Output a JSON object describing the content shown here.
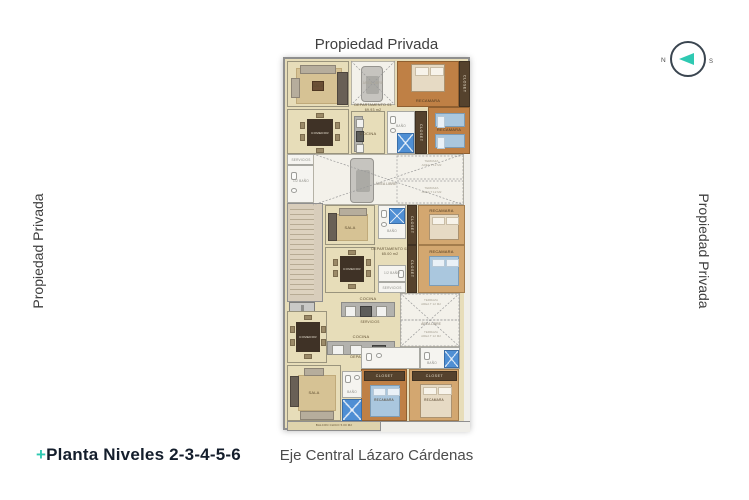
{
  "labels": {
    "propiedad_top": "Propiedad Privada",
    "propiedad_left": "Propiedad Privada",
    "propiedad_right": "Propiedad Privada",
    "street": "Eje Central Lázaro Cárdenas",
    "title_plus": "+",
    "title": "Planta Niveles 2-3-4-5-6"
  },
  "compass": {
    "north": "N",
    "south": "S"
  },
  "rooms": {
    "sala": "SALA",
    "comedor": "COMEDOR",
    "cocina": "COCINA",
    "bano": "BAÑO",
    "medio_bano": "1/2 BAÑO",
    "servicios": "SERVICIOS",
    "recamara": "RECAMARA",
    "closet": "CLOSET",
    "elevador": "ELEVADOR",
    "area_libre": "ÁREA LIBRE",
    "terraza": "TERRAZA",
    "terraza_area": "AREA T 12 M2",
    "balcon": "BALCON CHICO",
    "balcon_area": "5.00 M2"
  },
  "departamentos": {
    "d03": {
      "name": "DEPARTAMENTO 03",
      "area": "69.93 m2"
    },
    "d02": {
      "name": "DEPARTAMENTO 02",
      "area": "65.00 m2"
    },
    "d01": {
      "name": "DEPARTAMENTO 01",
      "area": "78.80 m2"
    }
  },
  "colors": {
    "accent_teal": "#2fc9b2",
    "wall_gray": "#8f8f8f",
    "floor_beige": "#e7ddb9",
    "bedroom_orange": "#bf8045",
    "bedroom_tan": "#d3a770",
    "closet_brown": "#55422d",
    "shower_blue": "#4f8fd4",
    "text_dark": "#141e2c",
    "text_gray": "#4c4c4c"
  }
}
